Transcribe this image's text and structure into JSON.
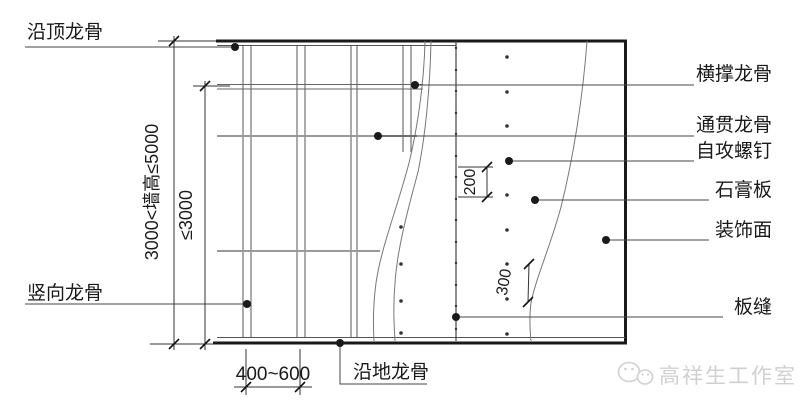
{
  "labels": {
    "ceiling_track": "沿顶龙骨",
    "vertical_stud": "竖向龙骨",
    "horizontal_brace_stud": "横撑龙骨",
    "through_stud": "通贯龙骨",
    "self_tapping_screw": "自攻螺钉",
    "gypsum_board": "石膏板",
    "decorative_surface": "装饰面",
    "board_seam": "板缝",
    "floor_track": "沿地龙骨"
  },
  "dimensions": {
    "wall_height_range": "3000<墙高≤5000",
    "inner_height_max": "≤3000",
    "stud_spacing": "400~600",
    "edge_screw_spacing": "200",
    "field_screw_spacing": "300"
  },
  "watermark": {
    "text": "高祥生工作室",
    "icon": "wechat-icon",
    "color": "#d0d0d0"
  },
  "colors": {
    "background": "#ffffff",
    "line_dark": "#1a1a1a",
    "line_medium": "#555555",
    "line_gray": "#999999"
  }
}
